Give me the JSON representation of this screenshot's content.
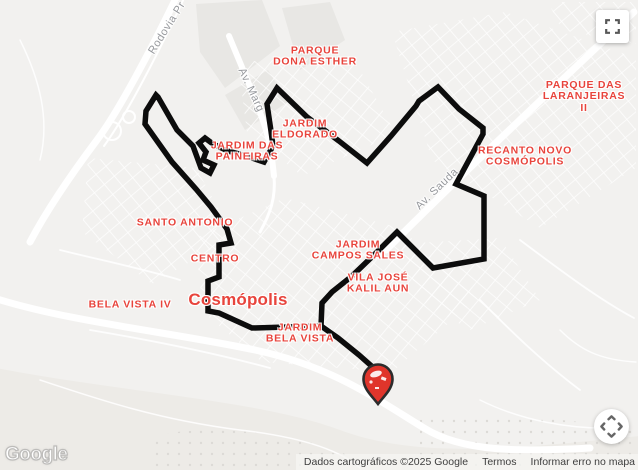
{
  "accent_colors": {
    "label_red": "#e8443c",
    "route_black": "#0c0c0c",
    "road_label_gray": "#97999d"
  },
  "map": {
    "city_label": "Cosmópolis",
    "districts": [
      {
        "text": "PARQUE\nDONA ESTHER"
      },
      {
        "text": "JARDIM\nELDORADO"
      },
      {
        "text": "JARDIM DAS\nPAINEIRAS"
      },
      {
        "text": "SANTO ANTONIO"
      },
      {
        "text": "CENTRO"
      },
      {
        "text": "BELA VISTA IV"
      },
      {
        "text": "JARDIM\nBELA VISTA"
      },
      {
        "text": "JARDIM\nCAMPOS SALES"
      },
      {
        "text": "VILA JOSÉ\nKALIL AUN"
      },
      {
        "text": "RECANTO NOVO\nCOSMÓPOLIS"
      },
      {
        "text": "PARQUE DAS\nLARANJEIRAS II"
      }
    ],
    "road_labels": [
      {
        "text": "Rodovia Pr"
      },
      {
        "text": "Av. Marg"
      },
      {
        "text": "Av. Sauda"
      }
    ],
    "route": {
      "main_path": "M156,95 L146,111 L145,124 L172,162 L196,189 L211,207 L227,229 L231,243 L219,245 L219,277 L208,281 L208,311 L219,313 L252,328 L321,326 L322,303 L332,292 L352,276 L377,252 L397,232 L433,268 L484,259 L484,196 L456,184 L483,134 L483,128 L459,109 L438,87 L419,101 L416,106 L391,136 L367,163 L339,141 L307,117 L277,88 L267,104 L271,131 L273,146 L264,162 L243,155 L228,151 L213,144 L205,138 L199,143 L206,152 L203,160 L214,165 L210,173 L201,168 L193,146 L177,130 L158,97 Z",
      "spur_path": "M321,326 L338,338 L359,355 L376,370"
    },
    "marker": {
      "name": "destination-pin",
      "fill": "#e0352b",
      "outline": "#2c2c2c"
    }
  },
  "controls": {
    "fullscreen_icon": "fullscreen-icon",
    "pan_icon": "pan-arrows-icon"
  },
  "branding": {
    "logo_text": "Google"
  },
  "attribution": {
    "copyright": "Dados cartográficos ©2025 Google",
    "terms": "Termos",
    "report": "Informar erro no mapa"
  }
}
